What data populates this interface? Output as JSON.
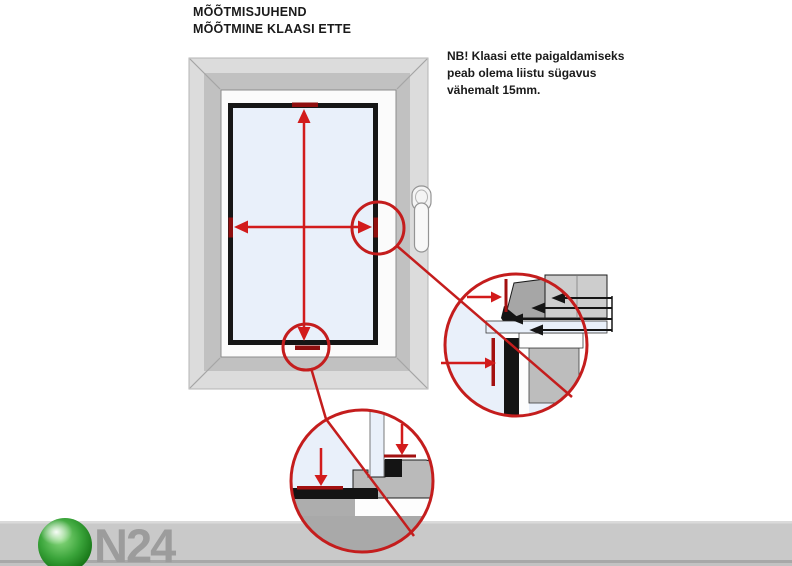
{
  "title": {
    "line1": "MÕÕTMISJUHEND",
    "line2": "MÕÕTMINE KLAASI ETTE"
  },
  "note": {
    "line1": "NB! Klaasi ette paigaldamiseks",
    "line2": "peab olema liistu sügavus",
    "line3": "vähemalt 15mm."
  },
  "logo": {
    "text": "N24"
  },
  "colors": {
    "callout_red": "#c41d1d",
    "arrow_red": "#d21b1b",
    "tick_dark_red": "#8f0f0f",
    "glass_blue": "#e9f0fa",
    "frame_light_gray": "#dcdcdc",
    "frame_jamb_gray": "#c1c1c1",
    "sash_white": "#fbfbfb",
    "bead_black": "#161616",
    "footer_band_gray": "#c9c9c9",
    "detail_gray": "#bdbdbd",
    "logo_green": "#1e8a1e",
    "logo_text_gray": "#9c9c9c"
  }
}
